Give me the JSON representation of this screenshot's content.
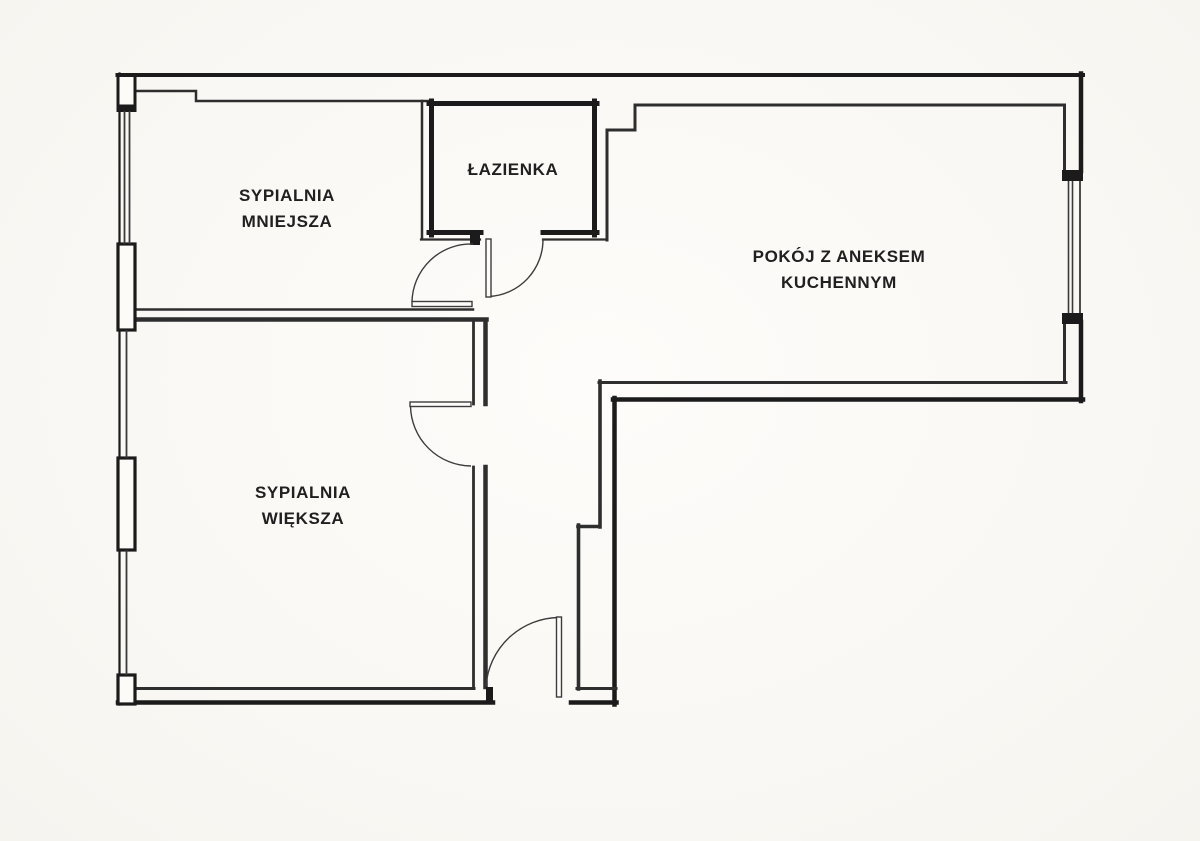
{
  "rooms": {
    "sypialnia_mniejsza": {
      "line1": "SYPIALNIA",
      "line2": "MNIEJSZA"
    },
    "lazienka": {
      "line1": "ŁAZIENKA"
    },
    "pokoj_z_aneksem": {
      "line1": "POKÓJ Z ANEKSEM",
      "line2": "KUCHENNYM"
    },
    "sypialnia_wieksza": {
      "line1": "SYPIALNIA",
      "line2": "WIĘKSZA"
    }
  },
  "colors": {
    "wall": "#1b1b1b",
    "inner_line": "#2e2e2e",
    "door_line": "#3c3c3c",
    "paper": "#faf8f4",
    "text": "#202020"
  }
}
